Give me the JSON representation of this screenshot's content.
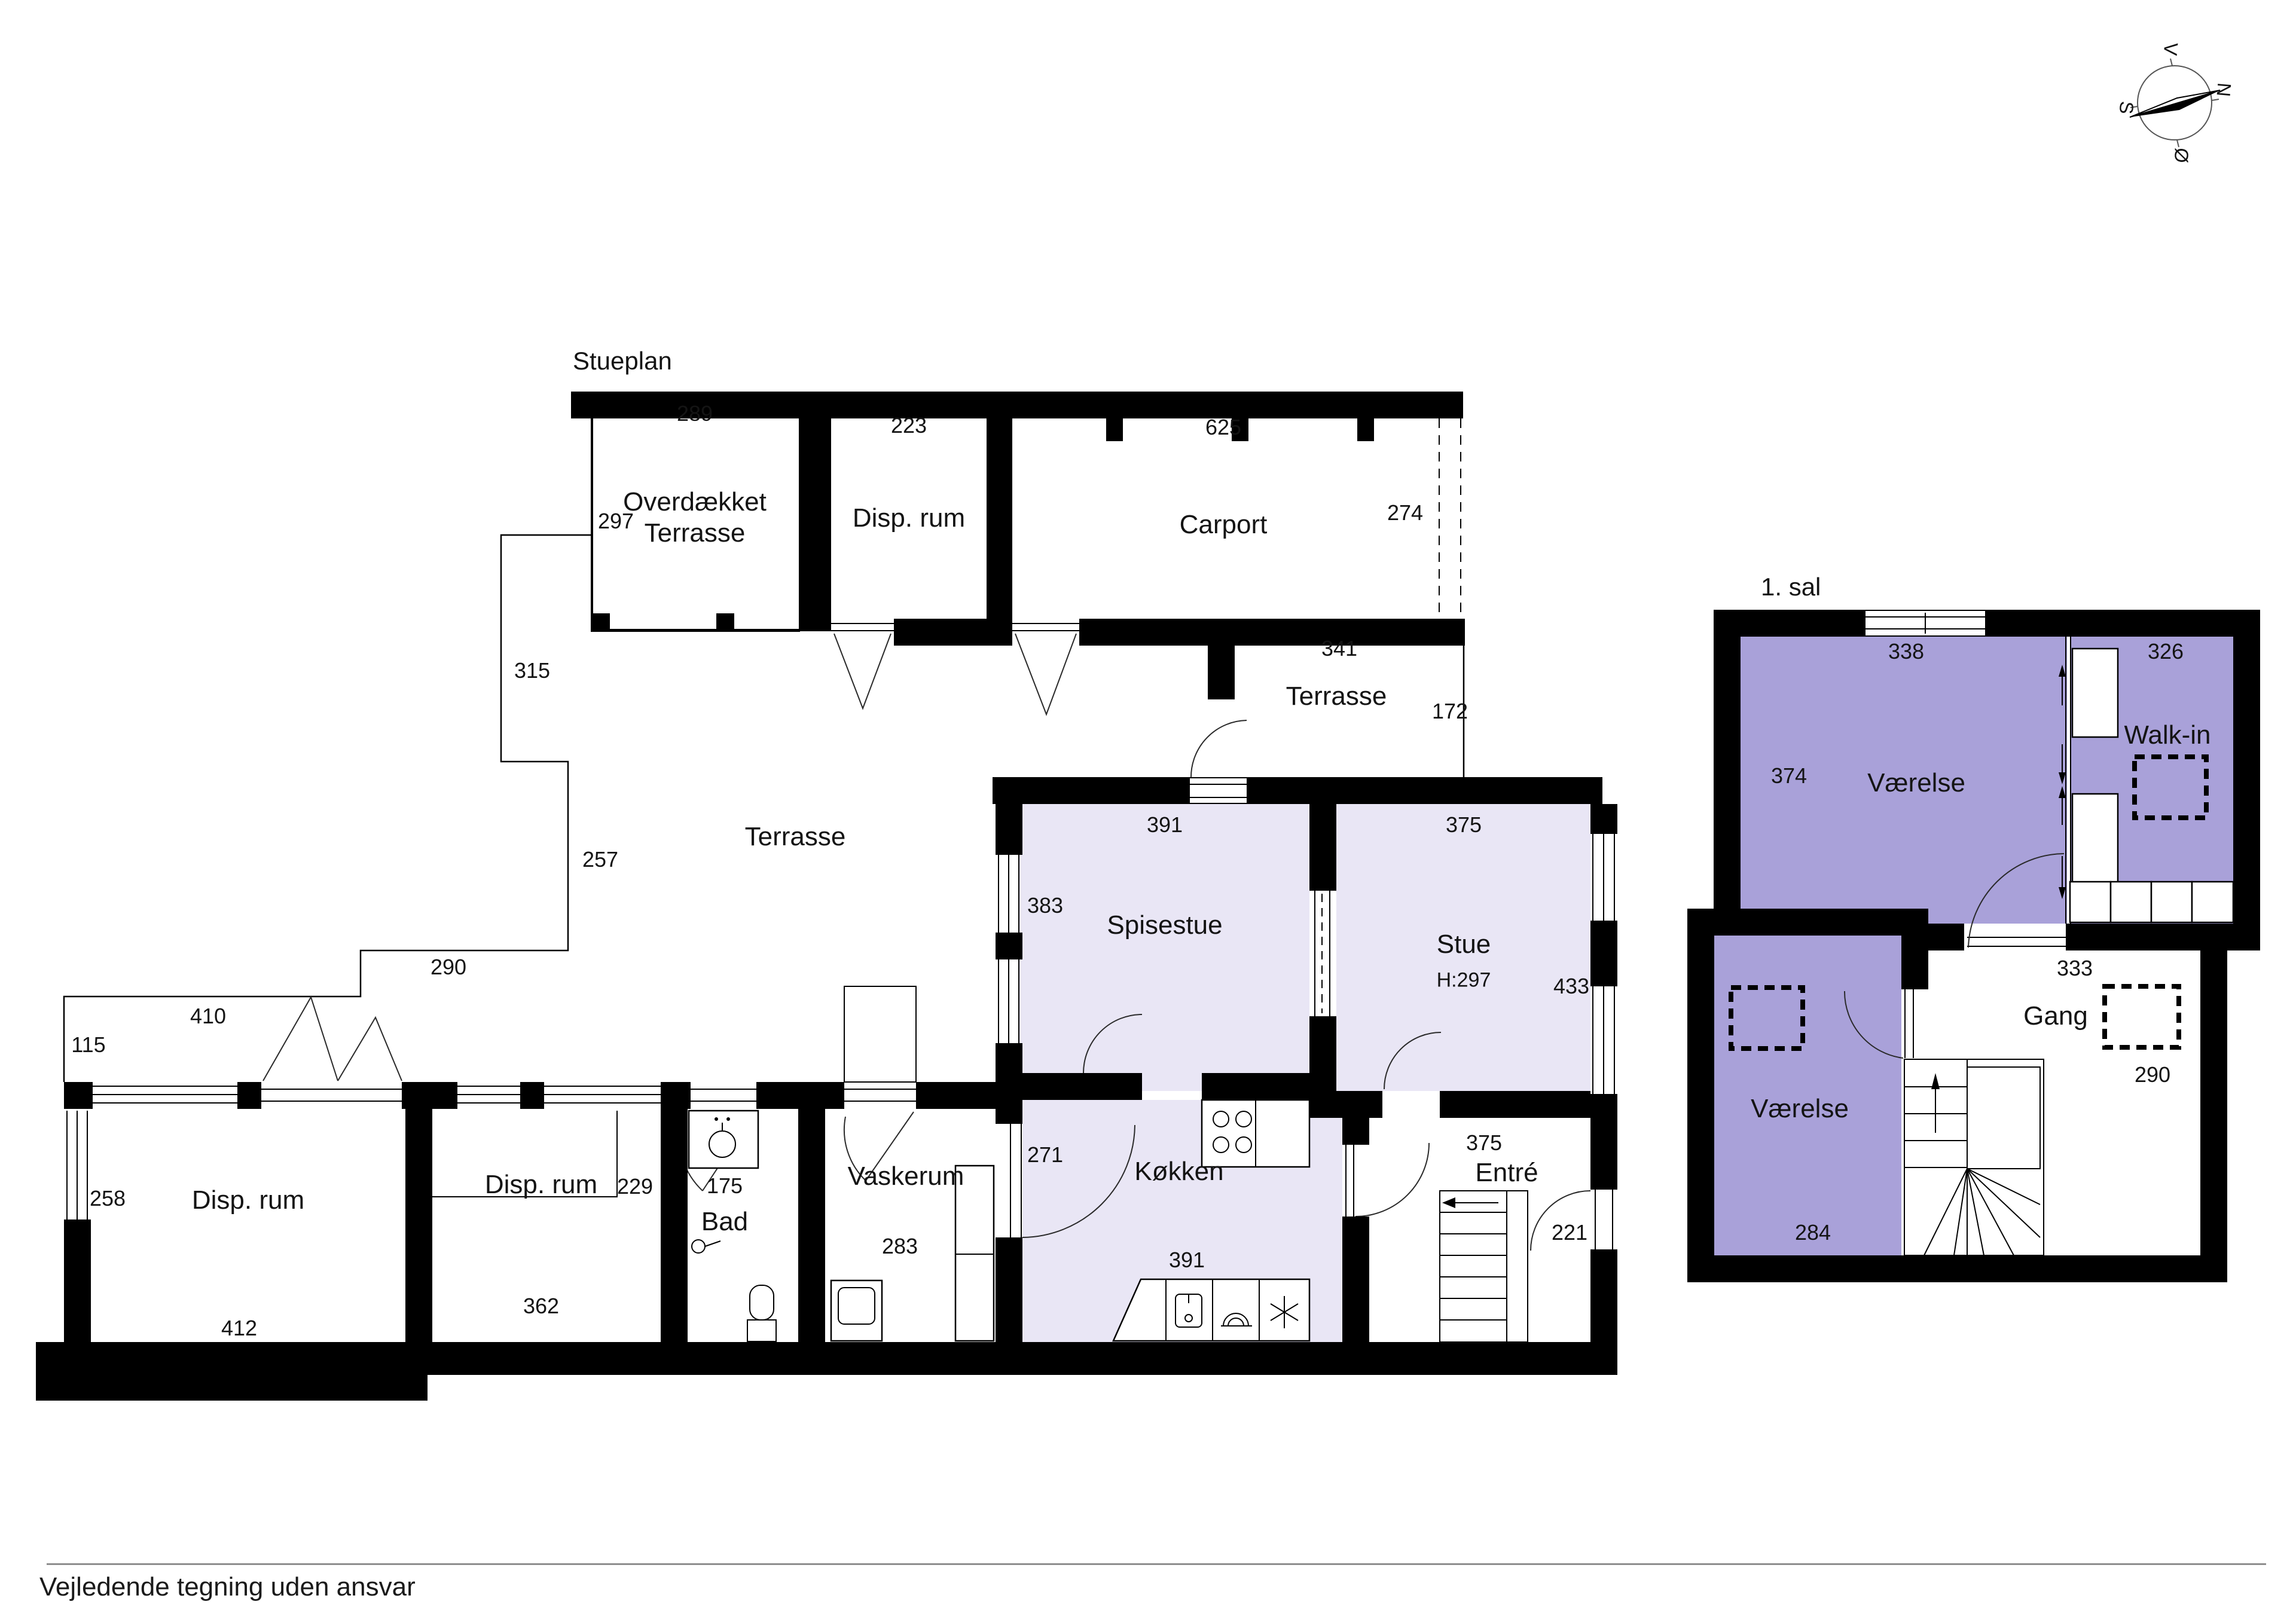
{
  "stueplan": {
    "title": "Stueplan",
    "rooms": {
      "overdaekket_l1": "Overdækket",
      "overdaekket_l2": "Terrasse",
      "disp_top": "Disp. rum",
      "carport": "Carport",
      "terrasse_upper": "Terrasse",
      "terrasse_main": "Terrasse",
      "spisestue": "Spisestue",
      "stue": "Stue",
      "stue_height": "H:297",
      "koekken": "Køkken",
      "entre": "Entré",
      "vaskerum": "Vaskerum",
      "bad": "Bad",
      "disp_left": "Disp. rum",
      "disp_mid": "Disp. rum"
    },
    "dims": {
      "d289": "289",
      "d223": "223",
      "d625": "625",
      "d274": "274",
      "d297": "297",
      "d341": "341",
      "d172": "172",
      "d391_top": "391",
      "d375_top": "375",
      "d383": "383",
      "d433": "433",
      "d271": "271",
      "d391_bottom": "391",
      "d375_entre": "375",
      "d221": "221",
      "d283": "283",
      "d175": "175",
      "d229": "229",
      "d362": "362",
      "d258": "258",
      "d412": "412",
      "d410": "410",
      "d115": "115",
      "d290": "290",
      "d257": "257",
      "d315": "315"
    }
  },
  "foerste_sal": {
    "title": "1. sal",
    "rooms": {
      "vaerelse_top": "Værelse",
      "walk_in": "Walk-in",
      "vaerelse_bottom": "Værelse",
      "gang": "Gang"
    },
    "dims": {
      "d338": "338",
      "d326": "326",
      "d374": "374",
      "d333": "333",
      "d290": "290",
      "d284": "284"
    }
  },
  "compass": {
    "north": "N",
    "south": "S",
    "west": "V",
    "east": "Ø"
  },
  "footer": {
    "disclaimer": "Vejledende tegning uden ansvar"
  },
  "colors": {
    "room_light": "#e9e6f5",
    "room_dark": "#a9a1d9",
    "wall": "#000000"
  }
}
